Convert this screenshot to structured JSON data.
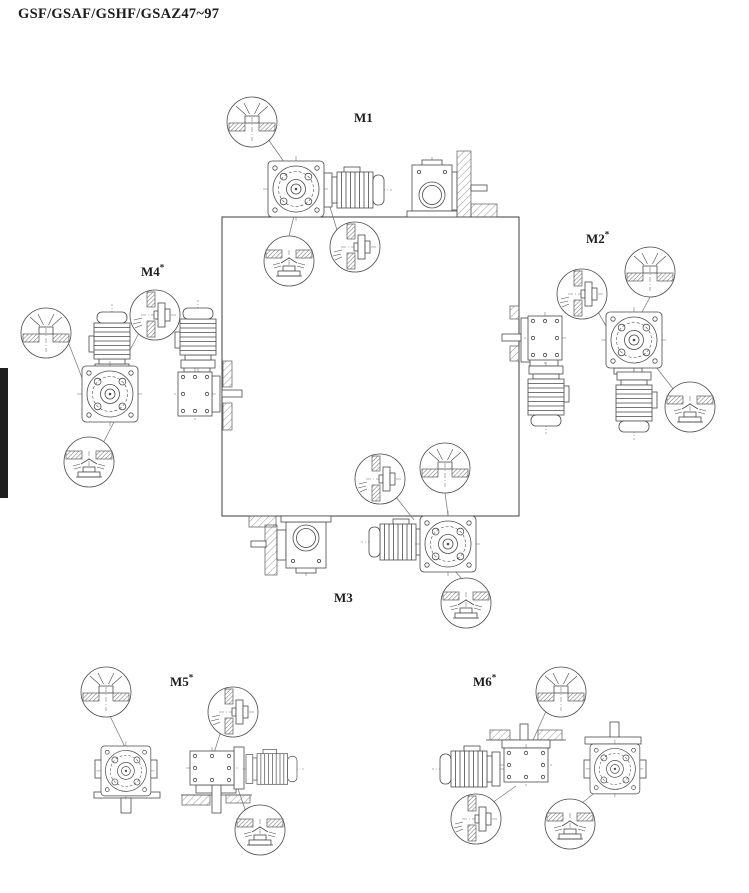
{
  "page": {
    "title": "GSF/GSAF/GSHF/GSAZ47~97"
  },
  "diagram": {
    "positions": [
      {
        "id": "m1",
        "label": "M1",
        "sup": ""
      },
      {
        "id": "m2",
        "label": "M2",
        "sup": "*"
      },
      {
        "id": "m3",
        "label": "M3",
        "sup": ""
      },
      {
        "id": "m4",
        "label": "M4",
        "sup": "*"
      },
      {
        "id": "m5",
        "label": "M5",
        "sup": "*"
      },
      {
        "id": "m6",
        "label": "M6",
        "sup": "*"
      }
    ],
    "icons": {
      "vent": "breather-plug-icon",
      "level": "oil-level-plug-icon",
      "drain": "oil-drain-plug-icon"
    },
    "colors": {
      "line": "#4a4a4a",
      "edge_tab": "#1f1f1f",
      "background": "#ffffff"
    }
  }
}
